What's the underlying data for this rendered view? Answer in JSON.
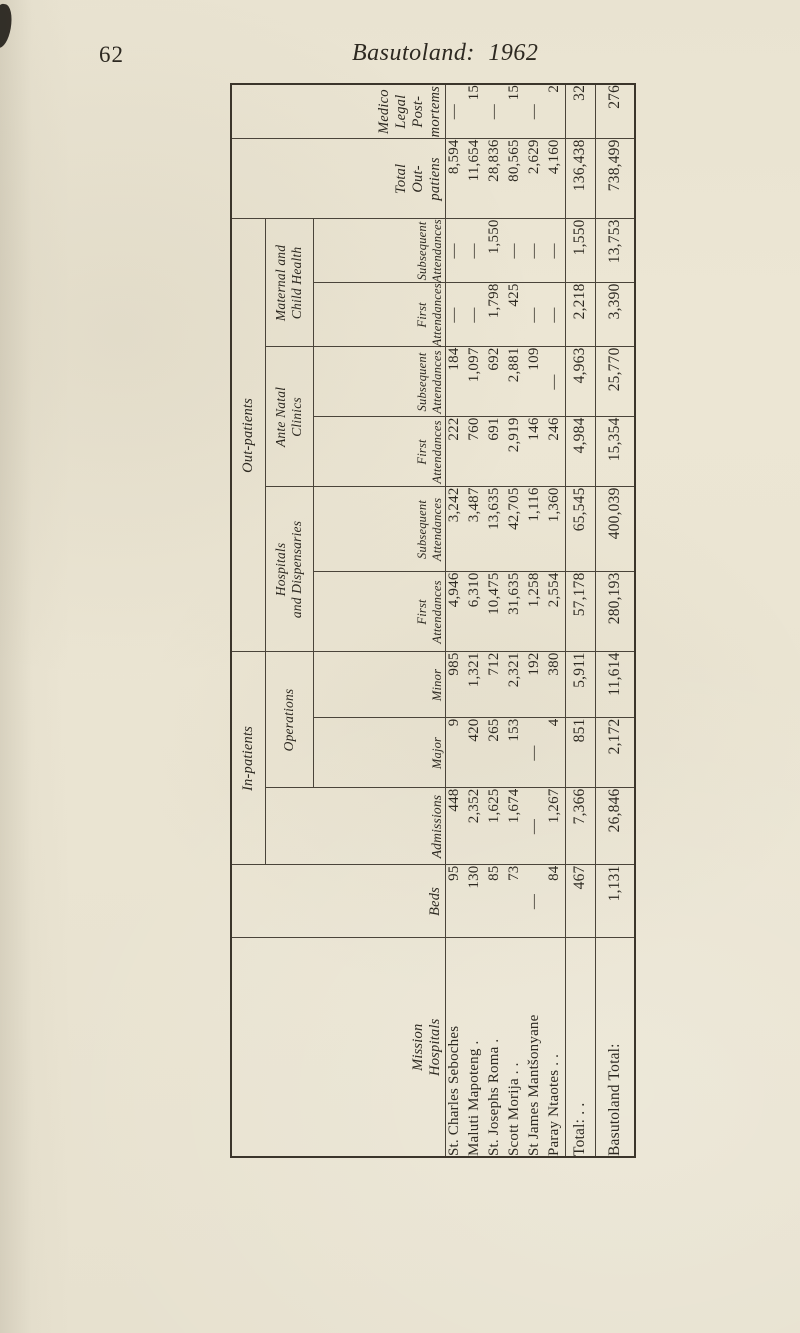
{
  "page": {
    "number": "62",
    "title": "Basutoland: 1962"
  },
  "colors": {
    "paper": "#e9e3d1",
    "ink": "#2d2921",
    "rule": "#4a443a"
  },
  "table": {
    "orientation": "rotated-90-ccw",
    "headers": {
      "mission_hospitals": "Mission\nHospitals",
      "beds": "Beds",
      "in_patients": "In-patients",
      "admissions": "Admissions",
      "operations": "Operations",
      "major": "Major",
      "minor": "Minor",
      "out_patients": "Out-patients",
      "hospitals_and_dispensaries": "Hospitals\nand Dispensaries",
      "ante_natal_clinics": "Ante Natal\nClinics",
      "maternal_and_child_health": "Maternal and\nChild Health",
      "first_attendances": "First\nAttendances",
      "subsequent_attendances": "Subsequent\nAttendances",
      "total_out_patients": "Total\nOut-\npatiens",
      "medico_legal_post_mortems": "Medico Legal\nPost-mortems"
    },
    "column_order": [
      "Beds",
      "Admissions",
      "Major Operations",
      "Minor Operations",
      "Hospitals and Dispensaries First Attendances",
      "Hospitals and Dispensaries Subsequent Attendances",
      "Ante Natal First Attendances",
      "Ante Natal Subsequent Attendances",
      "Maternal and Child Health First Attendances",
      "Maternal and Child Health Subsequent Attendances",
      "Total Out-patients",
      "Medico Legal Post-mortems"
    ],
    "rows": [
      {
        "name": "St. Charles Seboches",
        "values": [
          "95",
          "448",
          "9",
          "985",
          "4,946",
          "3,242",
          "222",
          "184",
          "—",
          "—",
          "8,594",
          "—"
        ]
      },
      {
        "name": "Maluti Mapoteng .",
        "values": [
          "130",
          "2,352",
          "420",
          "1,321",
          "6,310",
          "3,487",
          "760",
          "1,097",
          "—",
          "—",
          "11,654",
          "15"
        ]
      },
      {
        "name": "St. Josephs Roma .",
        "values": [
          "85",
          "1,625",
          "265",
          "712",
          "10,475",
          "13,635",
          "691",
          "692",
          "1,798",
          "1,550",
          "28,836",
          "—"
        ]
      },
      {
        "name": "Scott Morija .  .",
        "values": [
          "73",
          "1,674",
          "153",
          "2,321",
          "31,635",
          "42,705",
          "2,919",
          "2,881",
          "425",
          "—",
          "80,565",
          "15"
        ]
      },
      {
        "name": "St James Mantšonyane",
        "values": [
          "—",
          "—",
          "—",
          "192",
          "1,258",
          "1,116",
          "146",
          "109",
          "—",
          "—",
          "2,629",
          "—"
        ]
      },
      {
        "name": "Paray Ntaotes .  .",
        "values": [
          "84",
          "1,267",
          "4",
          "380",
          "2,554",
          "1,360",
          "246",
          "—",
          "—",
          "—",
          "4,160",
          "2"
        ]
      }
    ],
    "total_row": {
      "label": "Total:  .    .",
      "values": [
        "467",
        "7,366",
        "851",
        "5,911",
        "57,178",
        "65,545",
        "4,984",
        "4,963",
        "2,218",
        "1,550",
        "136,438",
        "32"
      ]
    },
    "grand_total_row": {
      "label": "Basutoland Total:",
      "values": [
        "1,131",
        "26,846",
        "2,172",
        "11,614",
        "280,193",
        "400,039",
        "15,354",
        "25,770",
        "3,390",
        "13,753",
        "738,499",
        "276"
      ]
    }
  }
}
